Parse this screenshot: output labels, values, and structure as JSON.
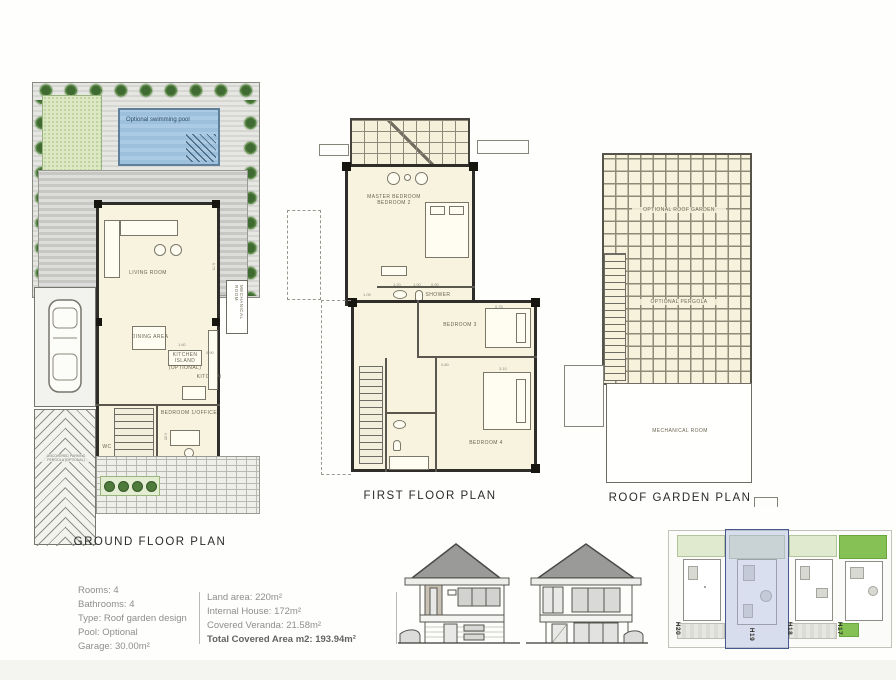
{
  "plans": {
    "ground": {
      "title": "GROUND FLOOR PLAN",
      "labels": {
        "pool": "Optional swimming pool",
        "living": "LIVING ROOM",
        "dining": "DINING AREA",
        "island1": "KITCHEN ISLAND",
        "island2": "(OPTIONAL)",
        "kitchen": "KITCHEN",
        "mechanical": "MECHANICAL ROOM",
        "bedroom_office": "BEDROOM 1/OFFICE",
        "wc": "WC",
        "parking1": "UNCOVERED PARKING",
        "parking2": "PERGOLA (OPTIONAL)"
      },
      "dims": {
        "d675": "6.75",
        "d160": "1.60",
        "d090": "0.90",
        "d080": "0.80",
        "d365": "3.65",
        "d240": "2.40",
        "d120": "1.20"
      }
    },
    "first": {
      "title": "FIRST FLOOR PLAN",
      "labels": {
        "master1": "MASTER BEDROOM",
        "master2": "BEDROOM 2",
        "shower": "SHOWER",
        "bedroom3": "BEDROOM 3",
        "bedroom4": "BEDROOM 4"
      },
      "dims": {
        "d105": "1.05",
        "d120": "1.20",
        "d100": "1.00",
        "d090": "0.90",
        "d075": "0.75",
        "d310": "3.10",
        "d080": "0.80"
      }
    },
    "roof": {
      "title": "ROOF GARDEN PLAN",
      "labels": {
        "roof_garden": "OPTIONAL ROOF GARDEN",
        "pergola": "OPTIONAL PERGOLA",
        "mechanical": "MECHANICAL ROOM"
      }
    }
  },
  "info": {
    "left": {
      "rooms": "Rooms: 4",
      "bathrooms": "Bathrooms: 4",
      "type": "Type: Roof garden design",
      "pool": "Pool: Optional",
      "garage": "Garage: 30.00m²"
    },
    "right": {
      "land": "Land area: 220m²",
      "internal": "Internal House: 172m²",
      "veranda": "Covered Veranda: 21.58m²",
      "total": "Total Covered Area m2: 193.94m²"
    }
  },
  "site": {
    "plots": [
      {
        "label": "H20"
      },
      {
        "label": "H19"
      },
      {
        "label": "H18"
      },
      {
        "label": "H17"
      }
    ]
  },
  "colors": {
    "tree_green": "#3f6b33",
    "lawn_green": "#dbe8c3",
    "pool_blue": "#9dc0dd",
    "floor_cream": "#f7f3df",
    "highlight_blue": "#47588c",
    "bright_green": "#86c155"
  }
}
